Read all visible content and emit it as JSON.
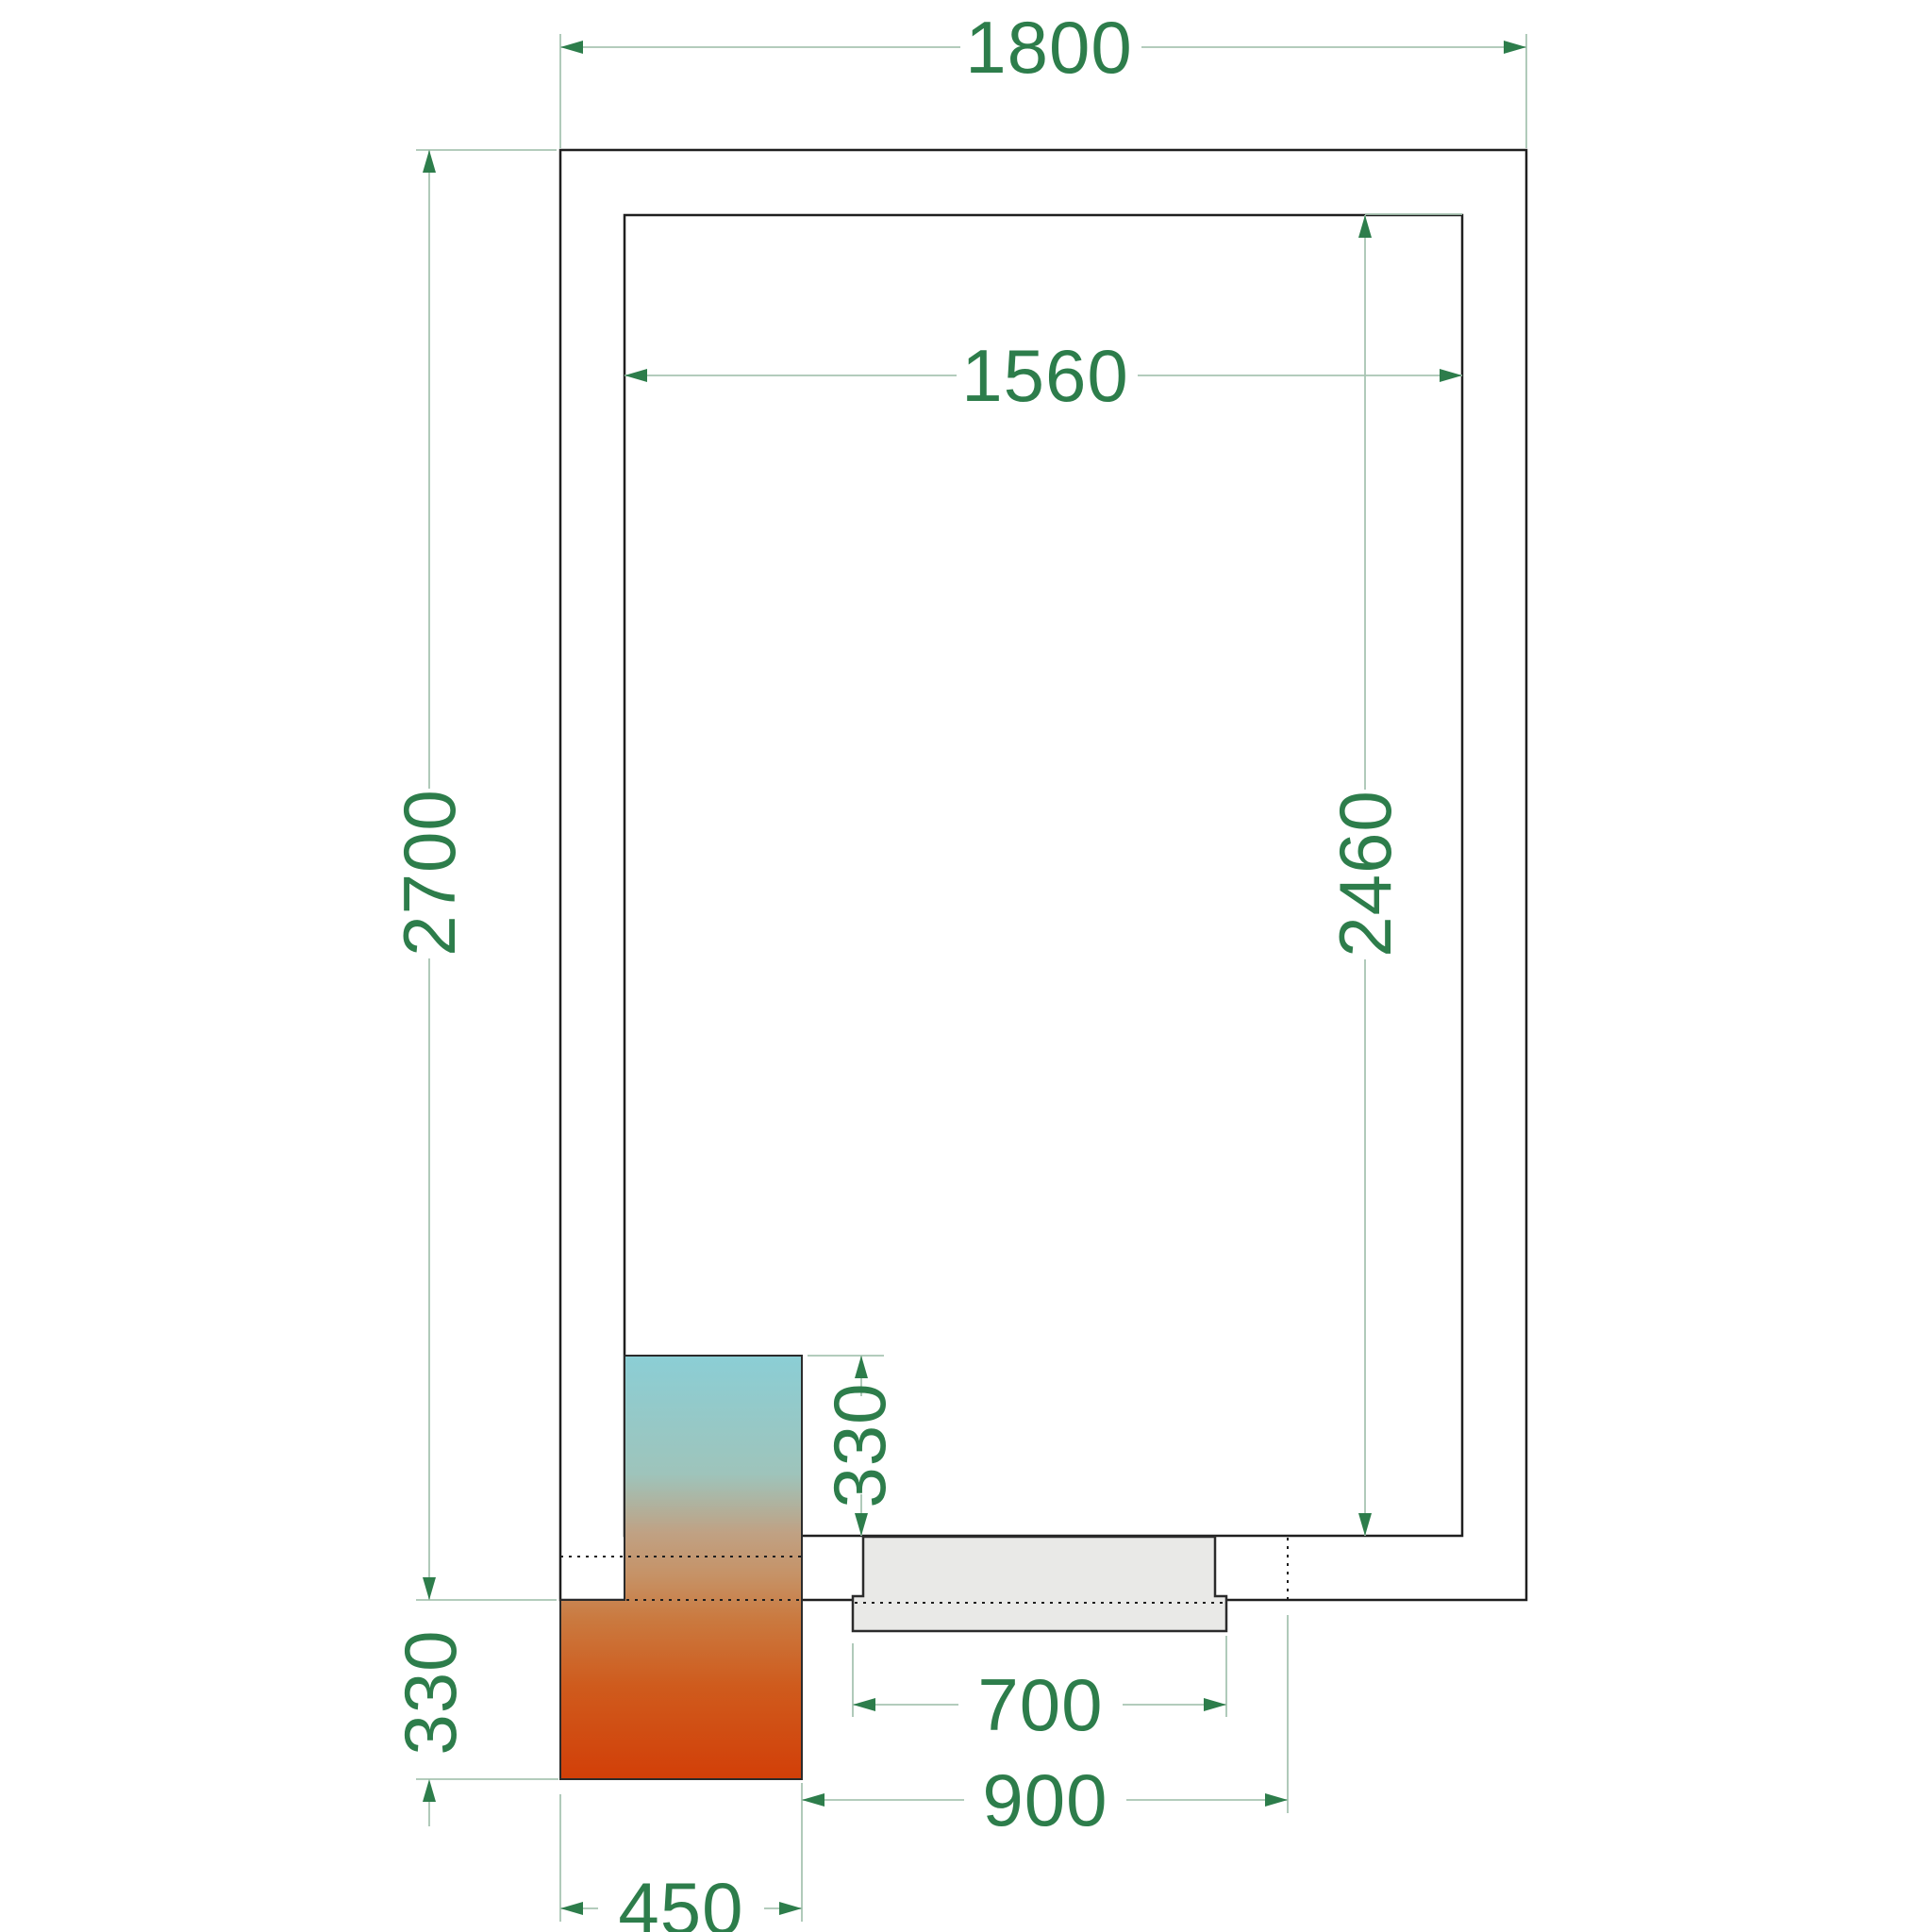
{
  "drawing": {
    "type": "cold-room-floor-plan",
    "dimensions": {
      "outer_width": "1800",
      "inner_width": "1560",
      "outer_depth": "2700",
      "inner_depth": "2460",
      "unit_inside_depth": "330",
      "unit_outside_depth": "330",
      "door_leaf_width": "700",
      "door_opening_width": "900",
      "unit_width": "450"
    },
    "colors": {
      "wall": "#1f1f1f",
      "dimtext": "#2d7d4b",
      "dimline": "#a8c4b2",
      "doorfill": "#e9e9e7",
      "doorstroke": "#2b2b2b",
      "unitstroke": "#2b2b2b",
      "grad0": "#8bced5",
      "grad1": "#9ec4bb",
      "grad2": "#c0a183",
      "grad3": "#c69266",
      "grad4": "#ca7a40",
      "grad5": "#cf5b1d",
      "grad6": "#d23f08"
    }
  }
}
